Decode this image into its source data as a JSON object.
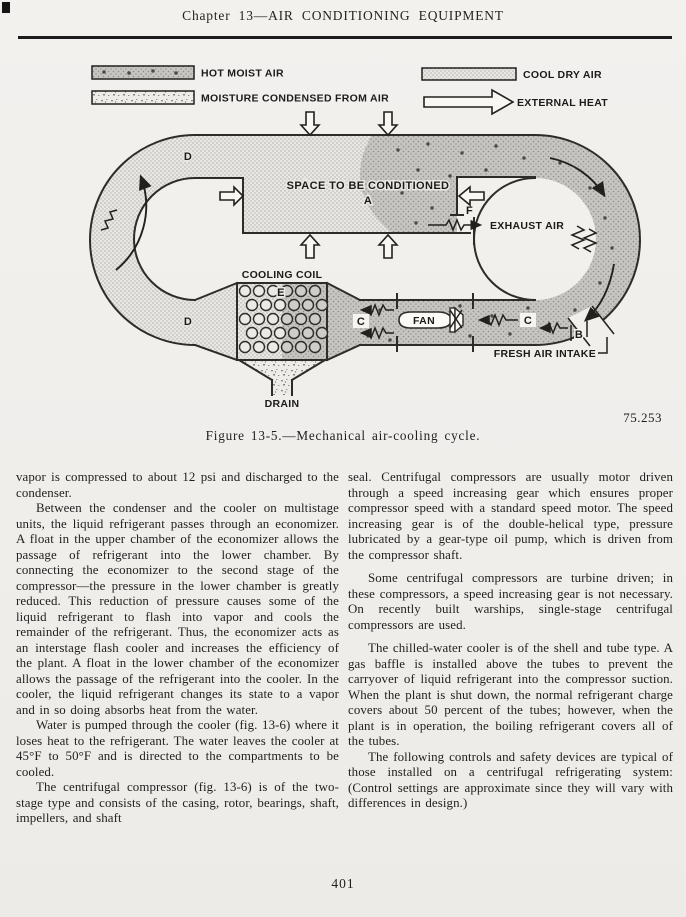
{
  "page": {
    "title": "Chapter 13—AIR CONDITIONING EQUIPMENT",
    "page_number": "401"
  },
  "figure": {
    "ref_number": "75.253",
    "caption": "Figure 13-5.—Mechanical air-cooling cycle.",
    "legend": {
      "hot_moist_air": "HOT MOIST AIR",
      "moisture_condensed": "MOISTURE CONDENSED FROM AIR",
      "cool_dry_air": "COOL DRY AIR",
      "external_heat": "EXTERNAL HEAT"
    },
    "labels": {
      "space": "SPACE TO BE CONDITIONED",
      "point_a": "A",
      "point_b": "B",
      "point_c": "C",
      "point_d": "D",
      "point_e": "E",
      "point_f": "F",
      "exhaust_air": "EXHAUST AIR",
      "fresh_air_intake": "FRESH AIR INTAKE",
      "cooling_coil": "COOLING COIL",
      "fan": "FAN",
      "drain": "DRAIN"
    }
  },
  "body": {
    "left": [
      {
        "text": "vapor is compressed to about 12 psi and discharged to the condenser."
      },
      {
        "text": "Between the condenser and the cooler on multistage units, the liquid refrigerant passes through an economizer. A float in the upper chamber of the economizer allows the passage of refrigerant into the lower chamber. By connecting the economizer to the second stage of the compressor—the pressure in the lower chamber is greatly reduced. This reduction of pressure causes some of the liquid refrigerant to flash into vapor and cools the remainder of the refrigerant. Thus, the economizer acts as an interstage flash cooler and increases the efficiency of the plant. A float in the lower chamber of the economizer allows the passage of the refrigerant into the cooler. In the cooler, the liquid refrigerant changes its state to a vapor and in so doing absorbs heat from the water."
      },
      {
        "text": "Water is pumped through the cooler (fig. 13-6) where it loses heat to the refrigerant. The water leaves the cooler at 45°F to 50°F and is directed to the compartments to be cooled."
      },
      {
        "text": "The centrifugal compressor (fig. 13-6) is of the two-stage type and consists of the casing, rotor, bearings, shaft, impellers, and shaft"
      }
    ],
    "right": [
      {
        "text": "seal. Centrifugal compressors are usually motor driven through a speed increasing gear which ensures proper compressor speed with a standard speed motor. The speed increasing gear is of the double-helical type, pressure lubricated by a gear-type oil pump, which is driven from the compressor shaft."
      },
      {
        "text": "Some centrifugal compressors are turbine driven; in these compressors, a speed increasing gear is not necessary. On recently built warships, single-stage centrifugal compressors are used."
      },
      {
        "text": "The chilled-water cooler is of the shell and tube type. A gas baffle is installed above the tubes to prevent the carryover of liquid refrigerant into the compressor suction. When the plant is shut down, the normal refrigerant charge covers about 50 percent of the tubes; however, when the plant is in operation, the boiling refrigerant covers all of the tubes."
      },
      {
        "text": "The following controls and safety devices are typical of those installed on a centrifugal refrigerating system: (Control settings are approximate since they will vary with differences in design.)"
      }
    ]
  },
  "colors": {
    "paper": "#f1efec",
    "ink": "#1e1e1e",
    "diagram_line": "#2e2c2a",
    "cool_fill": "#e8e7e3",
    "hot_fill": "#c6c5c1"
  }
}
